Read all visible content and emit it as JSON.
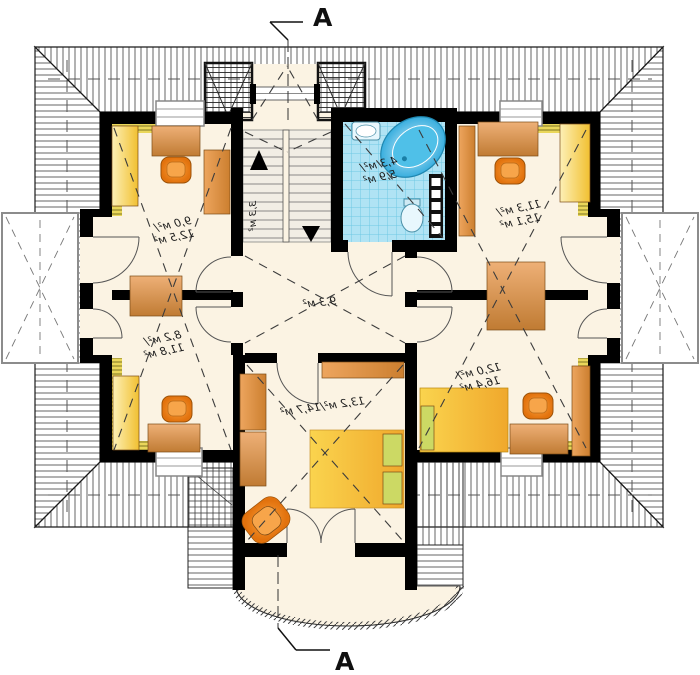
{
  "plan": {
    "type": "attic floor plan",
    "rooms": {
      "top_left": {
        "area1": "9,0 м²/",
        "area2": "12,5 м²"
      },
      "mid_left": {
        "area1": "8,2 м²/",
        "area2": "11,8 м²"
      },
      "top_right": {
        "area1": "11,3 м²/",
        "area2": "15,1 м²"
      },
      "bottom_right": {
        "area1": "12,0 м²/",
        "area2": "16,4 м²"
      },
      "bathroom": {
        "area1": "4,3 м²/",
        "area2": "5,9 м²"
      },
      "hall": {
        "area": "9,3 м²"
      },
      "bedroom": {
        "area": "13,2 м²/14,7 м²"
      },
      "staircase": {
        "area": "3,3 м²"
      }
    },
    "section": {
      "top": "A",
      "bottom": "A"
    },
    "colors": {
      "floor": "#fbf3e3",
      "wall": "#000000",
      "roof_hatch": "#3f3f3f",
      "knee_wall": "#ead75a",
      "bath_tile": "#b0e3f4",
      "bathtub": "#39aede",
      "wood_furniture": "#cc7f2f",
      "wardrobe": "#f1c031",
      "chair": "#e2720d",
      "bed": "#f0a82c",
      "pillow": "#ccd964"
    }
  }
}
